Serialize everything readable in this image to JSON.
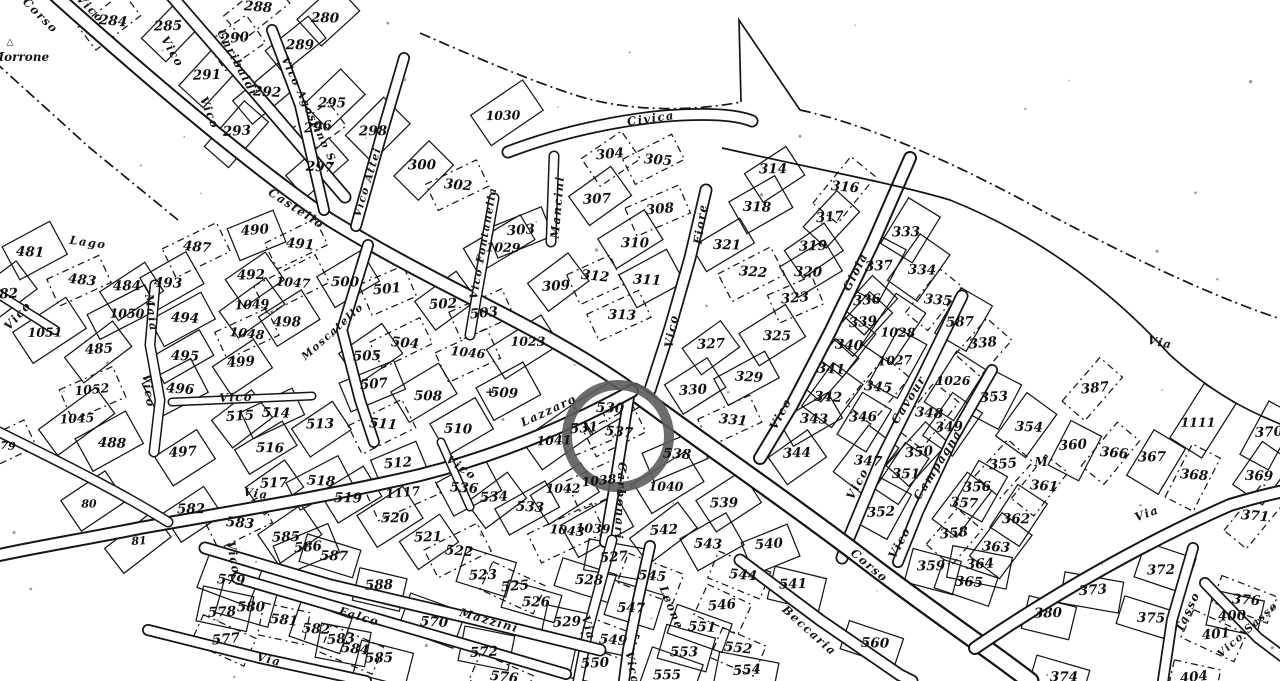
{
  "map": {
    "type": "cadastral-scan",
    "ink_color": "#151515",
    "paper_color": "#ffffff",
    "highlight": {
      "parcel": "537",
      "cx": 618,
      "cy": 436,
      "r": 51,
      "stroke": "#5c5c5c",
      "stroke_width": 10
    },
    "parcels": [
      {
        "n": "284",
        "x": 113,
        "y": 22
      },
      {
        "n": "285",
        "x": 168,
        "y": 27
      },
      {
        "n": "288",
        "x": 258,
        "y": 8
      },
      {
        "n": "280",
        "x": 325,
        "y": 19
      },
      {
        "n": "290",
        "x": 235,
        "y": 39
      },
      {
        "n": "289",
        "x": 300,
        "y": 46
      },
      {
        "n": "291",
        "x": 207,
        "y": 76
      },
      {
        "n": "292",
        "x": 267,
        "y": 93
      },
      {
        "n": "295",
        "x": 332,
        "y": 104
      },
      {
        "n": "296",
        "x": 318,
        "y": 128
      },
      {
        "n": "298",
        "x": 373,
        "y": 132
      },
      {
        "n": "293",
        "x": 237,
        "y": 132
      },
      {
        "n": "297",
        "x": 320,
        "y": 168
      },
      {
        "n": "300",
        "x": 422,
        "y": 166
      },
      {
        "n": "302",
        "x": 458,
        "y": 186
      },
      {
        "n": "1030",
        "x": 503,
        "y": 116
      },
      {
        "n": "303",
        "x": 521,
        "y": 231
      },
      {
        "n": "1029",
        "x": 503,
        "y": 248
      },
      {
        "n": "304",
        "x": 610,
        "y": 155
      },
      {
        "n": "305",
        "x": 658,
        "y": 161
      },
      {
        "n": "307",
        "x": 597,
        "y": 200
      },
      {
        "n": "308",
        "x": 660,
        "y": 210
      },
      {
        "n": "310",
        "x": 635,
        "y": 244
      },
      {
        "n": "312",
        "x": 595,
        "y": 277
      },
      {
        "n": "311",
        "x": 647,
        "y": 281
      },
      {
        "n": "309",
        "x": 556,
        "y": 287
      },
      {
        "n": "313",
        "x": 622,
        "y": 316
      },
      {
        "n": "314",
        "x": 773,
        "y": 170
      },
      {
        "n": "316",
        "x": 845,
        "y": 188
      },
      {
        "n": "318",
        "x": 757,
        "y": 208
      },
      {
        "n": "317",
        "x": 830,
        "y": 218
      },
      {
        "n": "321",
        "x": 727,
        "y": 246
      },
      {
        "n": "319",
        "x": 813,
        "y": 247
      },
      {
        "n": "322",
        "x": 753,
        "y": 273
      },
      {
        "n": "320",
        "x": 808,
        "y": 273
      },
      {
        "n": "323",
        "x": 795,
        "y": 299
      },
      {
        "n": "325",
        "x": 777,
        "y": 337
      },
      {
        "n": "327",
        "x": 711,
        "y": 345
      },
      {
        "n": "329",
        "x": 749,
        "y": 378
      },
      {
        "n": "330",
        "x": 693,
        "y": 391
      },
      {
        "n": "331",
        "x": 733,
        "y": 421
      },
      {
        "n": "333",
        "x": 906,
        "y": 233
      },
      {
        "n": "337",
        "x": 879,
        "y": 267
      },
      {
        "n": "334",
        "x": 922,
        "y": 271
      },
      {
        "n": "336",
        "x": 867,
        "y": 301
      },
      {
        "n": "335",
        "x": 938,
        "y": 301
      },
      {
        "n": "587",
        "x": 960,
        "y": 323
      },
      {
        "n": "339",
        "x": 863,
        "y": 323
      },
      {
        "n": "1028",
        "x": 898,
        "y": 333
      },
      {
        "n": "338",
        "x": 983,
        "y": 344
      },
      {
        "n": "340",
        "x": 849,
        "y": 346
      },
      {
        "n": "1027",
        "x": 895,
        "y": 361
      },
      {
        "n": "341",
        "x": 831,
        "y": 370
      },
      {
        "n": "1026",
        "x": 953,
        "y": 381
      },
      {
        "n": "345",
        "x": 878,
        "y": 388
      },
      {
        "n": "342",
        "x": 828,
        "y": 398
      },
      {
        "n": "353",
        "x": 994,
        "y": 398
      },
      {
        "n": "343",
        "x": 814,
        "y": 420
      },
      {
        "n": "346",
        "x": 863,
        "y": 418
      },
      {
        "n": "348",
        "x": 929,
        "y": 414
      },
      {
        "n": "349",
        "x": 949,
        "y": 428
      },
      {
        "n": "350",
        "x": 919,
        "y": 453
      },
      {
        "n": "351",
        "x": 906,
        "y": 475
      },
      {
        "n": "344",
        "x": 797,
        "y": 454
      },
      {
        "n": "347",
        "x": 868,
        "y": 462
      },
      {
        "n": "352",
        "x": 881,
        "y": 513
      },
      {
        "n": "387",
        "x": 1095,
        "y": 389
      },
      {
        "n": "1111",
        "x": 1198,
        "y": 423
      },
      {
        "n": "370",
        "x": 1269,
        "y": 433
      },
      {
        "n": "354",
        "x": 1029,
        "y": 428
      },
      {
        "n": "360",
        "x": 1073,
        "y": 446
      },
      {
        "n": "366",
        "x": 1114,
        "y": 454
      },
      {
        "n": "367",
        "x": 1152,
        "y": 458
      },
      {
        "n": "368",
        "x": 1194,
        "y": 476
      },
      {
        "n": "369",
        "x": 1259,
        "y": 477
      },
      {
        "n": "355",
        "x": 1003,
        "y": 465
      },
      {
        "n": "361",
        "x": 1044,
        "y": 487
      },
      {
        "n": "356",
        "x": 977,
        "y": 488
      },
      {
        "n": "357",
        "x": 964,
        "y": 504
      },
      {
        "n": "362",
        "x": 1016,
        "y": 520
      },
      {
        "n": "358",
        "x": 954,
        "y": 534
      },
      {
        "n": "363",
        "x": 996,
        "y": 548
      },
      {
        "n": "364",
        "x": 980,
        "y": 565
      },
      {
        "n": "365",
        "x": 969,
        "y": 583
      },
      {
        "n": "359",
        "x": 931,
        "y": 567
      },
      {
        "n": "371",
        "x": 1255,
        "y": 517
      },
      {
        "n": "372",
        "x": 1161,
        "y": 571
      },
      {
        "n": "373",
        "x": 1093,
        "y": 591
      },
      {
        "n": "375",
        "x": 1151,
        "y": 619
      },
      {
        "n": "380",
        "x": 1048,
        "y": 614
      },
      {
        "n": "376",
        "x": 1246,
        "y": 601
      },
      {
        "n": "400",
        "x": 1232,
        "y": 617
      },
      {
        "n": "401",
        "x": 1216,
        "y": 635
      },
      {
        "n": "374",
        "x": 1064,
        "y": 678
      },
      {
        "n": "404",
        "x": 1194,
        "y": 678
      },
      {
        "n": "481",
        "x": 30,
        "y": 253
      },
      {
        "n": "482",
        "x": 4,
        "y": 295
      },
      {
        "n": "483",
        "x": 82,
        "y": 281
      },
      {
        "n": "484",
        "x": 127,
        "y": 287
      },
      {
        "n": "487",
        "x": 197,
        "y": 248
      },
      {
        "n": "493",
        "x": 168,
        "y": 284
      },
      {
        "n": "490",
        "x": 255,
        "y": 231
      },
      {
        "n": "491",
        "x": 300,
        "y": 245
      },
      {
        "n": "492",
        "x": 251,
        "y": 276
      },
      {
        "n": "1047",
        "x": 293,
        "y": 283
      },
      {
        "n": "500",
        "x": 345,
        "y": 283
      },
      {
        "n": "501",
        "x": 387,
        "y": 290
      },
      {
        "n": "1050",
        "x": 127,
        "y": 314
      },
      {
        "n": "1049",
        "x": 252,
        "y": 305
      },
      {
        "n": "494",
        "x": 185,
        "y": 319
      },
      {
        "n": "498",
        "x": 287,
        "y": 323
      },
      {
        "n": "1048",
        "x": 247,
        "y": 334
      },
      {
        "n": "1051",
        "x": 45,
        "y": 333
      },
      {
        "n": "485",
        "x": 99,
        "y": 350
      },
      {
        "n": "495",
        "x": 185,
        "y": 357
      },
      {
        "n": "499",
        "x": 241,
        "y": 363
      },
      {
        "n": "504",
        "x": 405,
        "y": 344
      },
      {
        "n": "505",
        "x": 367,
        "y": 357
      },
      {
        "n": "507",
        "x": 374,
        "y": 385
      },
      {
        "n": "508",
        "x": 428,
        "y": 397
      },
      {
        "n": "1052",
        "x": 92,
        "y": 390
      },
      {
        "n": "496",
        "x": 180,
        "y": 390
      },
      {
        "n": "502",
        "x": 443,
        "y": 305
      },
      {
        "n": "503",
        "x": 484,
        "y": 314
      },
      {
        "n": "1023",
        "x": 528,
        "y": 342
      },
      {
        "n": "1046",
        "x": 468,
        "y": 353
      },
      {
        "n": "509",
        "x": 504,
        "y": 394
      },
      {
        "n": "515",
        "x": 240,
        "y": 417
      },
      {
        "n": "514",
        "x": 276,
        "y": 414
      },
      {
        "n": "513",
        "x": 320,
        "y": 425
      },
      {
        "n": "511",
        "x": 383,
        "y": 425
      },
      {
        "n": "510",
        "x": 458,
        "y": 430
      },
      {
        "n": "512",
        "x": 398,
        "y": 464
      },
      {
        "n": "516",
        "x": 270,
        "y": 449
      },
      {
        "n": "517",
        "x": 274,
        "y": 484
      },
      {
        "n": "518",
        "x": 321,
        "y": 482
      },
      {
        "n": "519",
        "x": 348,
        "y": 499
      },
      {
        "n": "1117",
        "x": 403,
        "y": 493
      },
      {
        "n": "520",
        "x": 395,
        "y": 519
      },
      {
        "n": "1045",
        "x": 77,
        "y": 419
      },
      {
        "n": "488",
        "x": 112,
        "y": 444
      },
      {
        "n": "497",
        "x": 183,
        "y": 453
      },
      {
        "n": "79",
        "x": 8,
        "y": 446,
        "s": 11
      },
      {
        "n": "80",
        "x": 89,
        "y": 504,
        "s": 11
      },
      {
        "n": "81",
        "x": 139,
        "y": 541,
        "s": 11
      },
      {
        "n": "530",
        "x": 610,
        "y": 409
      },
      {
        "n": "531",
        "x": 584,
        "y": 429
      },
      {
        "n": "537",
        "x": 619,
        "y": 433
      },
      {
        "n": "1041",
        "x": 554,
        "y": 441
      },
      {
        "n": "538",
        "x": 677,
        "y": 455
      },
      {
        "n": "1040",
        "x": 666,
        "y": 487
      },
      {
        "n": "1038",
        "x": 599,
        "y": 481
      },
      {
        "n": "536",
        "x": 464,
        "y": 489
      },
      {
        "n": "534",
        "x": 494,
        "y": 498
      },
      {
        "n": "533",
        "x": 530,
        "y": 508
      },
      {
        "n": "1042",
        "x": 563,
        "y": 489
      },
      {
        "n": "1043",
        "x": 567,
        "y": 531
      },
      {
        "n": "1039",
        "x": 593,
        "y": 529
      },
      {
        "n": "527",
        "x": 614,
        "y": 558
      },
      {
        "n": "528",
        "x": 589,
        "y": 581
      },
      {
        "n": "521",
        "x": 428,
        "y": 538
      },
      {
        "n": "522",
        "x": 459,
        "y": 552
      },
      {
        "n": "523",
        "x": 483,
        "y": 576
      },
      {
        "n": "525",
        "x": 515,
        "y": 587
      },
      {
        "n": "526",
        "x": 536,
        "y": 603
      },
      {
        "n": "529",
        "x": 567,
        "y": 623
      },
      {
        "n": "570",
        "x": 434,
        "y": 623
      },
      {
        "n": "572",
        "x": 484,
        "y": 653
      },
      {
        "n": "576",
        "x": 504,
        "y": 678
      },
      {
        "n": "539",
        "x": 724,
        "y": 504
      },
      {
        "n": "542",
        "x": 664,
        "y": 531
      },
      {
        "n": "543",
        "x": 708,
        "y": 545
      },
      {
        "n": "540",
        "x": 769,
        "y": 545
      },
      {
        "n": "544",
        "x": 743,
        "y": 576
      },
      {
        "n": "541",
        "x": 793,
        "y": 585
      },
      {
        "n": "545",
        "x": 652,
        "y": 577
      },
      {
        "n": "547",
        "x": 631,
        "y": 609
      },
      {
        "n": "546",
        "x": 722,
        "y": 606
      },
      {
        "n": "549",
        "x": 613,
        "y": 641
      },
      {
        "n": "550",
        "x": 595,
        "y": 664
      },
      {
        "n": "551",
        "x": 702,
        "y": 628
      },
      {
        "n": "553",
        "x": 684,
        "y": 653
      },
      {
        "n": "552",
        "x": 738,
        "y": 649
      },
      {
        "n": "555",
        "x": 667,
        "y": 676
      },
      {
        "n": "554",
        "x": 747,
        "y": 671
      },
      {
        "n": "560",
        "x": 875,
        "y": 644
      },
      {
        "n": "582",
        "x": 191,
        "y": 510
      },
      {
        "n": "583",
        "x": 240,
        "y": 524
      },
      {
        "n": "585",
        "x": 286,
        "y": 538
      },
      {
        "n": "586",
        "x": 308,
        "y": 548
      },
      {
        "n": "587",
        "x": 334,
        "y": 557
      },
      {
        "n": "588",
        "x": 379,
        "y": 586
      },
      {
        "n": "579",
        "x": 231,
        "y": 581
      },
      {
        "n": "578",
        "x": 222,
        "y": 613
      },
      {
        "n": "577",
        "x": 226,
        "y": 640
      },
      {
        "n": "580",
        "x": 251,
        "y": 608
      },
      {
        "n": "581",
        "x": 284,
        "y": 621
      },
      {
        "n": "582",
        "x": 316,
        "y": 630
      },
      {
        "n": "583",
        "x": 341,
        "y": 640
      },
      {
        "n": "584",
        "x": 355,
        "y": 650
      },
      {
        "n": "585",
        "x": 379,
        "y": 659
      }
    ],
    "streets": [
      {
        "name": "Corso",
        "x": 40,
        "y": 16,
        "rot": 45
      },
      {
        "name": "Vico",
        "x": 90,
        "y": 9,
        "rot": 45
      },
      {
        "name": "Vico",
        "x": 172,
        "y": 52,
        "rot": 60
      },
      {
        "name": "Garibaldi",
        "x": 237,
        "y": 63,
        "rot": 62
      },
      {
        "name": "Vico",
        "x": 209,
        "y": 113,
        "rot": 68
      },
      {
        "name": "Vico Agostino S.",
        "x": 309,
        "y": 112,
        "rot": 65
      },
      {
        "name": "Lago",
        "x": 88,
        "y": 243,
        "rot": 8
      },
      {
        "name": "Castello",
        "x": 296,
        "y": 209,
        "rot": 33
      },
      {
        "name": "Vico Attei",
        "x": 368,
        "y": 182,
        "rot": -73
      },
      {
        "name": "Civica",
        "x": 651,
        "y": 119,
        "rot": -8
      },
      {
        "name": "Mancini",
        "x": 558,
        "y": 207,
        "rot": -85
      },
      {
        "name": "Vico Fontanella",
        "x": 484,
        "y": 243,
        "rot": -80
      },
      {
        "name": "Fiore",
        "x": 701,
        "y": 224,
        "rot": -82
      },
      {
        "name": "Gioia",
        "x": 856,
        "y": 272,
        "rot": -63
      },
      {
        "name": "Vico",
        "x": 672,
        "y": 331,
        "rot": -80
      },
      {
        "name": "Vico",
        "x": 781,
        "y": 414,
        "rot": -62
      },
      {
        "name": "Cavour",
        "x": 909,
        "y": 400,
        "rot": -58
      },
      {
        "name": "Campagna",
        "x": 938,
        "y": 465,
        "rot": -58
      },
      {
        "name": "Vico",
        "x": 858,
        "y": 484,
        "rot": -62
      },
      {
        "name": "Vico",
        "x": 900,
        "y": 543,
        "rot": -62
      },
      {
        "name": "Via",
        "x": 1160,
        "y": 343,
        "rot": 12
      },
      {
        "name": "Via",
        "x": 1147,
        "y": 514,
        "rot": -20
      },
      {
        "name": "Corso",
        "x": 869,
        "y": 566,
        "rot": 40
      },
      {
        "name": "Beccaria",
        "x": 809,
        "y": 631,
        "rot": 42
      },
      {
        "name": "Mazzini",
        "x": 489,
        "y": 621,
        "rot": 16
      },
      {
        "name": "Falco",
        "x": 359,
        "y": 617,
        "rot": 16
      },
      {
        "name": "Via",
        "x": 269,
        "y": 660,
        "rot": 13
      },
      {
        "name": "Via",
        "x": 256,
        "y": 494,
        "rot": 8
      },
      {
        "name": "Vico",
        "x": 233,
        "y": 558,
        "rot": 80
      },
      {
        "name": "Vico",
        "x": 236,
        "y": 398,
        "rot": -2
      },
      {
        "name": "Moscatello",
        "x": 333,
        "y": 332,
        "rot": -42
      },
      {
        "name": "Maia",
        "x": 151,
        "y": 313,
        "rot": 82
      },
      {
        "name": "Vico",
        "x": 148,
        "y": 391,
        "rot": 82
      },
      {
        "name": "Vico",
        "x": 18,
        "y": 316,
        "rot": -48
      },
      {
        "name": "Lazzaro",
        "x": 549,
        "y": 411,
        "rot": -25
      },
      {
        "name": "Carbonari",
        "x": 620,
        "y": 501,
        "rot": 93
      },
      {
        "name": "Via",
        "x": 588,
        "y": 628,
        "rot": 75
      },
      {
        "name": "Leone",
        "x": 671,
        "y": 608,
        "rot": 68
      },
      {
        "name": "Vico",
        "x": 632,
        "y": 668,
        "rot": 78
      },
      {
        "name": "Vico",
        "x": 461,
        "y": 468,
        "rot": 35
      },
      {
        "name": "Tasso",
        "x": 1188,
        "y": 612,
        "rot": -65
      },
      {
        "name": "Vico Sasso",
        "x": 1248,
        "y": 630,
        "rot": -42
      }
    ],
    "landmarks": [
      {
        "name": "morrone-label",
        "text": "Morrone",
        "x": 20,
        "y": 57
      },
      {
        "name": "mountain-triangle",
        "text": "△",
        "x": 10,
        "y": 43
      },
      {
        "name": "survey-cross",
        "text": "+",
        "x": 490,
        "y": 392
      },
      {
        "name": "letter-m-mark",
        "text": "M",
        "x": 1041,
        "y": 462
      }
    ]
  }
}
